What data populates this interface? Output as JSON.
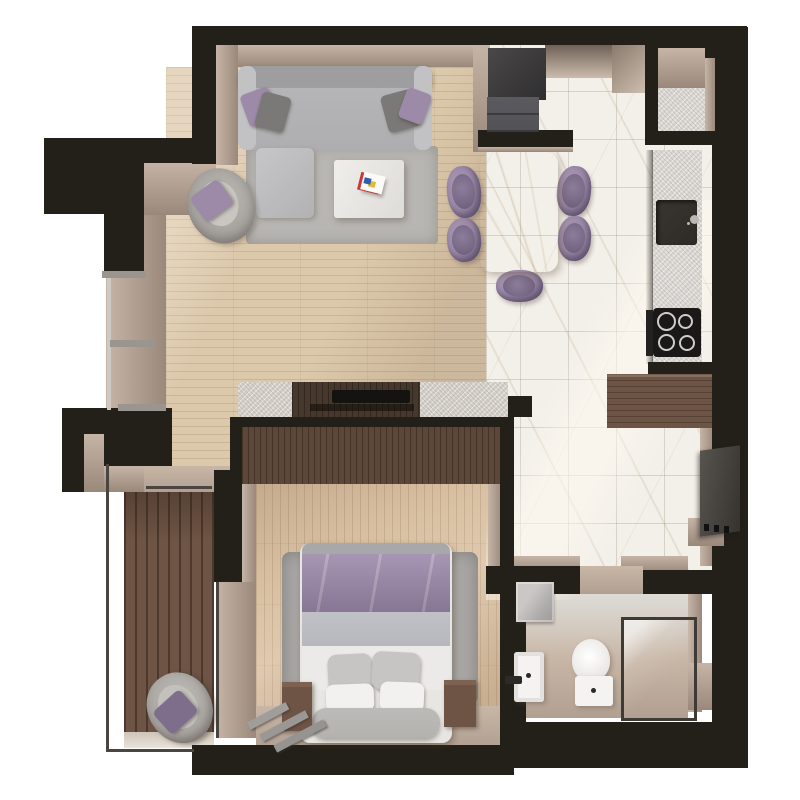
{
  "meta": {
    "view": "top-down 3D render of a one-bedroom apartment floor plan",
    "no_visible_text": true
  },
  "palette": {
    "wall": "#232019",
    "wall_soft": "#2e2a26",
    "wall_face": "#c6b5a7",
    "wall_face_dark": "#9a897b",
    "floor_living": "#dcc8ab",
    "floor_bedroom": "#d8bfa1",
    "floor_balcony": "#6d5444",
    "marble": "#f3f0ea",
    "beige_floor": "#c8b6a6",
    "beige_floor_dark": "#b1a092",
    "rug_living": "#b8b6b3",
    "rug_bedroom": "#a9a7a4",
    "sofa": "#b5b5b7",
    "sofa_dark": "#9f9fa1",
    "cushion_gray": "#7b7977",
    "purple": "#9c8aa8",
    "purple_dark": "#7e6e8c",
    "stone": "#d4cfc9",
    "counter": "#dad7d2",
    "sink_dark": "#2e2a26",
    "cooktop": "#1b1917",
    "burner_ring": "#cfcdc9",
    "wood_dark": "#5d4739",
    "wood_cabinet": "#6e5444",
    "tv_screen": "#45413d",
    "white_fixture": "#f4f3f1",
    "glass_frame": "#3e3a36",
    "mat": "#3d3c3e",
    "closet": "#515156",
    "window_frame": "#9a958e",
    "railing": "#4a453f",
    "bed_white": "#eceae8",
    "bed_gray": "#b6b7bc",
    "headboard": "#b4b2af"
  },
  "scene": {
    "rooms": [
      {
        "name": "living-room",
        "floor": "light oak planks",
        "furniture": [
          "sofa with purple and gray cushions",
          "ottoman",
          "gray rug",
          "coffee table with books",
          "armchair with purple cushion",
          "tv wall unit with stone pillars"
        ]
      },
      {
        "name": "dining-area",
        "floor": "white marble tile",
        "furniture": [
          "marble dining table",
          "5 purple dining chairs"
        ]
      },
      {
        "name": "kitchen",
        "floor": "white marble tile",
        "furniture": [
          "counter run",
          "dark inset sink",
          "cooktop with 4 burners",
          "upper cabinet",
          "wood dresser"
        ]
      },
      {
        "name": "entry",
        "floor": "white marble tile",
        "furniture": [
          "dark doormat",
          "closet"
        ]
      },
      {
        "name": "hallway",
        "floor": "white marble tile",
        "furniture": [
          "wall-mounted tv",
          "console ledge"
        ]
      },
      {
        "name": "bedroom",
        "floor": "warm oak planks",
        "furniture": [
          "double bed with purple duvet",
          "4 pillows",
          "2 wood nightstands",
          "shag rug",
          "wardrobe",
          "steps to balcony"
        ]
      },
      {
        "name": "balcony",
        "floor": "dark wood decking",
        "furniture": [
          "lounge chair with purple cushion",
          "glass railing"
        ]
      },
      {
        "name": "bathroom",
        "floor": "beige screed",
        "furniture": [
          "vanity sink with black faucet",
          "mirror",
          "toilet",
          "glass shower enclosure"
        ]
      }
    ],
    "counts": {
      "dining_chairs": 5,
      "cooktop_burners": 4,
      "bed_pillows": 4,
      "sofa_cushions": 4,
      "window_mullions": 3
    }
  }
}
